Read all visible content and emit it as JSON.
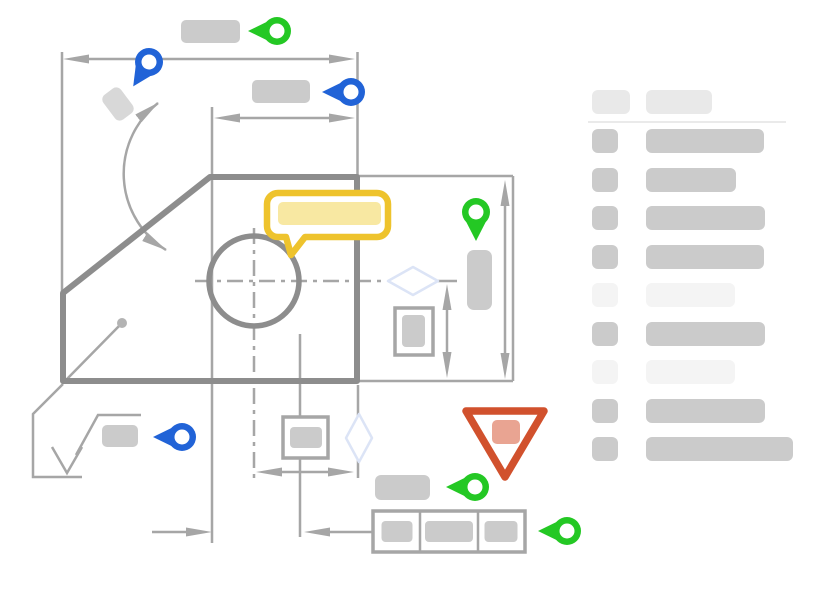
{
  "colors": {
    "background": "#ffffff",
    "accent_green": "#24c824",
    "accent_blue": "#2163d7",
    "accent_yellow": "#eec32d",
    "callout_fill": "#f8e8a2",
    "warning_red": "#d1512d",
    "warning_fill": "#e9a492",
    "outline_dark": "#8d8d8d",
    "line_gray": "#a6a6a6",
    "placeholder_gray": "#cbcbcb",
    "placeholder_soft": "#d8d8d8",
    "placeholder_light": "#f4f4f4",
    "placeholder_header": "#e9e9e9",
    "divider": "#eaeaea",
    "diamond_blue": "#dce4f6",
    "dot_gray": "#b3b3b3"
  },
  "drawing": {
    "annotation_markers": [
      {
        "name": "pin-top-width-label",
        "shape": "pin-left",
        "color": "green"
      },
      {
        "name": "pin-overall-width-dim",
        "shape": "pin-down-left",
        "color": "blue"
      },
      {
        "name": "pin-upper-width-label",
        "shape": "pin-left",
        "color": "blue"
      },
      {
        "name": "pin-height-dim",
        "shape": "pin-down",
        "color": "green"
      },
      {
        "name": "pin-surface-finish",
        "shape": "pin-left",
        "color": "blue"
      },
      {
        "name": "pin-datum-label",
        "shape": "pin-left",
        "color": "green"
      },
      {
        "name": "pin-feature-control-frame",
        "shape": "pin-left",
        "color": "green"
      }
    ],
    "callout": {
      "type": "comment-bubble",
      "color": "yellow"
    },
    "warning": {
      "type": "inverted-warning-triangle",
      "color": "red"
    },
    "symbols": [
      {
        "name": "hole-circle-with-centerlines"
      },
      {
        "name": "surface-finish-symbol"
      },
      {
        "name": "feature-control-frame",
        "cells": 3
      },
      {
        "name": "diamond-symbol",
        "count": 2
      }
    ]
  },
  "legend": {
    "header": {
      "badge_width_px": 38,
      "title_width_px": 66
    },
    "rows": [
      {
        "index": 1,
        "emphasis": "normal",
        "bar_width_px": 118
      },
      {
        "index": 2,
        "emphasis": "normal",
        "bar_width_px": 90
      },
      {
        "index": 3,
        "emphasis": "normal",
        "bar_width_px": 119
      },
      {
        "index": 4,
        "emphasis": "normal",
        "bar_width_px": 118
      },
      {
        "index": 5,
        "emphasis": "muted",
        "bar_width_px": 89
      },
      {
        "index": 6,
        "emphasis": "normal",
        "bar_width_px": 119
      },
      {
        "index": 7,
        "emphasis": "muted",
        "bar_width_px": 89
      },
      {
        "index": 8,
        "emphasis": "normal",
        "bar_width_px": 119
      },
      {
        "index": 9,
        "emphasis": "normal",
        "bar_width_px": 147
      }
    ]
  }
}
